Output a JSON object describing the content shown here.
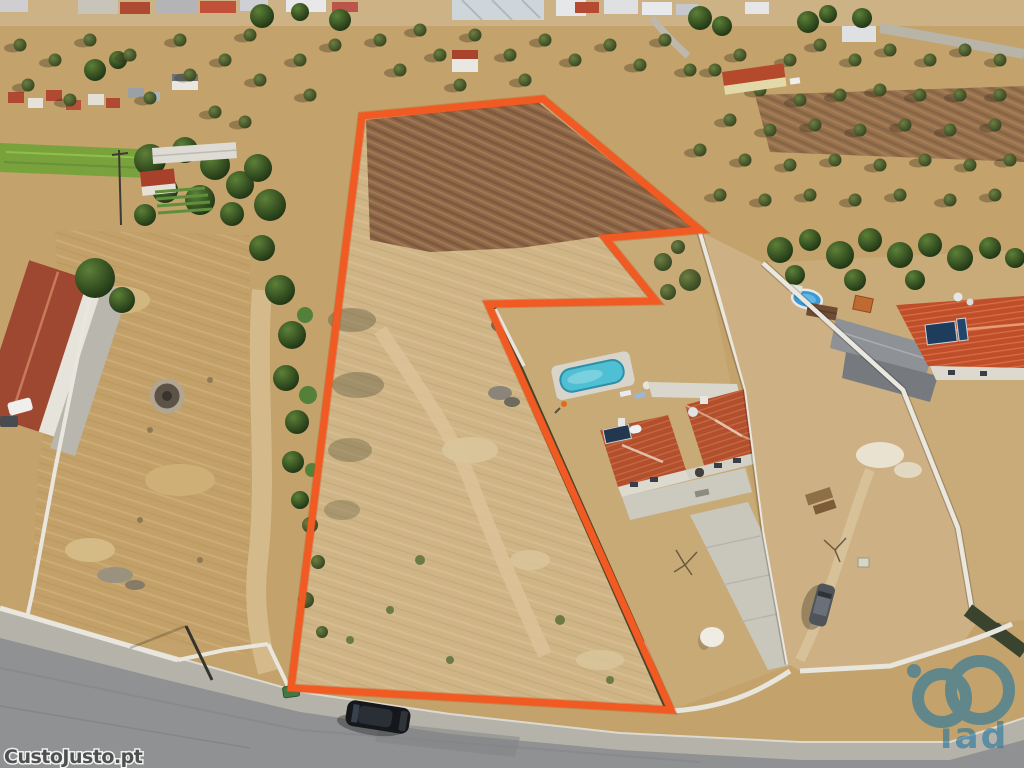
{
  "watermarks": {
    "custojusto": {
      "text": "CustoJusto.pt",
      "color": "#4f4f4f"
    },
    "iad": {
      "text": "iad",
      "color": "#2878a0"
    }
  },
  "colors": {
    "boundary": "#f15a22",
    "pool_water": "#4fc0d4",
    "road_gray": "#8f9193",
    "roof_red": "#b2502e"
  }
}
